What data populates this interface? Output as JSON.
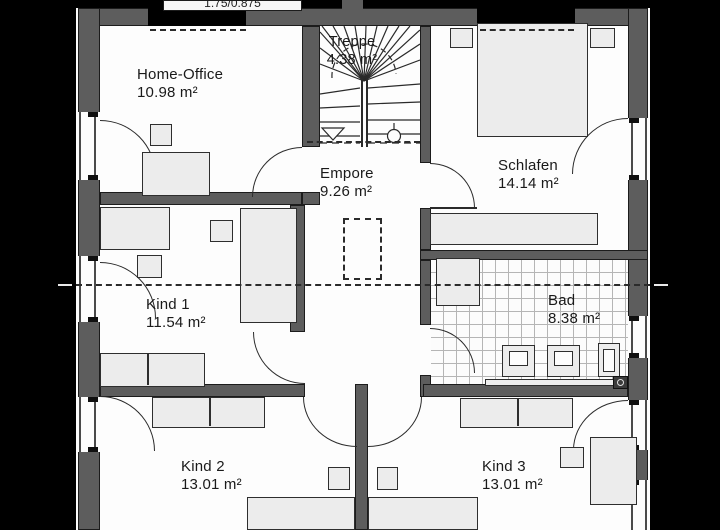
{
  "header": {
    "dimension_label": "1.75/0.875"
  },
  "rooms": [
    {
      "id": "home-office",
      "name": "Home-Office",
      "area": "10.98 m²"
    },
    {
      "id": "treppe",
      "name": "Treppe",
      "area": "4.38 m²"
    },
    {
      "id": "schlafen",
      "name": "Schlafen",
      "area": "14.14 m²"
    },
    {
      "id": "empore",
      "name": "Empore",
      "area": "9.26 m²"
    },
    {
      "id": "kind-1",
      "name": "Kind 1",
      "area": "11.54 m²"
    },
    {
      "id": "bad",
      "name": "Bad",
      "area": "8.38 m²"
    },
    {
      "id": "kind-2",
      "name": "Kind 2",
      "area": "13.01 m²"
    },
    {
      "id": "kind-3",
      "name": "Kind 3",
      "area": "13.01 m²"
    }
  ],
  "colors": {
    "background": "#000000",
    "wall": "#5d5d5d",
    "wall_outline": "#1c1c1c",
    "room": "#fdfdfd",
    "furniture": "#ececec",
    "line": "#2b2b2b",
    "tile_line": "#b5b5b5"
  }
}
